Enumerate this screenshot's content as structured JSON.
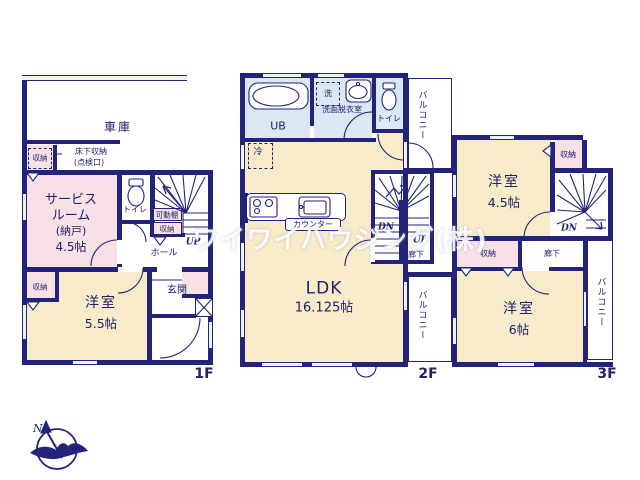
{
  "watermark": "ワイワイハウジング(株)",
  "compass": {
    "north": "N"
  },
  "floors": {
    "f1": {
      "label": "1F",
      "garage": "車庫",
      "storage_upper": "収納",
      "underfloor_l1": "床下収納",
      "underfloor_l2": "(点検口)",
      "service_l1": "サービス",
      "service_l2": "ルーム",
      "service_l3": "(納戸)",
      "service_l4": "4.5帖",
      "toilet": "トイレ",
      "movable_shelf": "可動棚",
      "stair_storage": "収納",
      "up": "UP",
      "hall": "ホール",
      "entrance": "玄関",
      "bedroom": "洋室",
      "bedroom_size": "5.5帖",
      "storage_lower": "収納"
    },
    "f2": {
      "label": "2F",
      "ub": "UB",
      "washer": "洗",
      "washroom": "洗面脱衣室",
      "toilet": "トイレ",
      "balcony_top": "バルコニー",
      "fridge": "冷",
      "counter": "カウンター",
      "ldk": "LDK",
      "ldk_size": "16.125帖",
      "dn": "DN",
      "up": "UP",
      "hallway": "廊下",
      "balcony_bottom": "バルコニー"
    },
    "f3": {
      "label": "3F",
      "storage_top": "収納",
      "bedroom1": "洋室",
      "bedroom1_size": "4.5帖",
      "dn": "DN",
      "storage_mid": "収納",
      "hallway": "廊下",
      "bedroom2": "洋室",
      "bedroom2_size": "6帖",
      "balcony": "バルコニー"
    }
  }
}
